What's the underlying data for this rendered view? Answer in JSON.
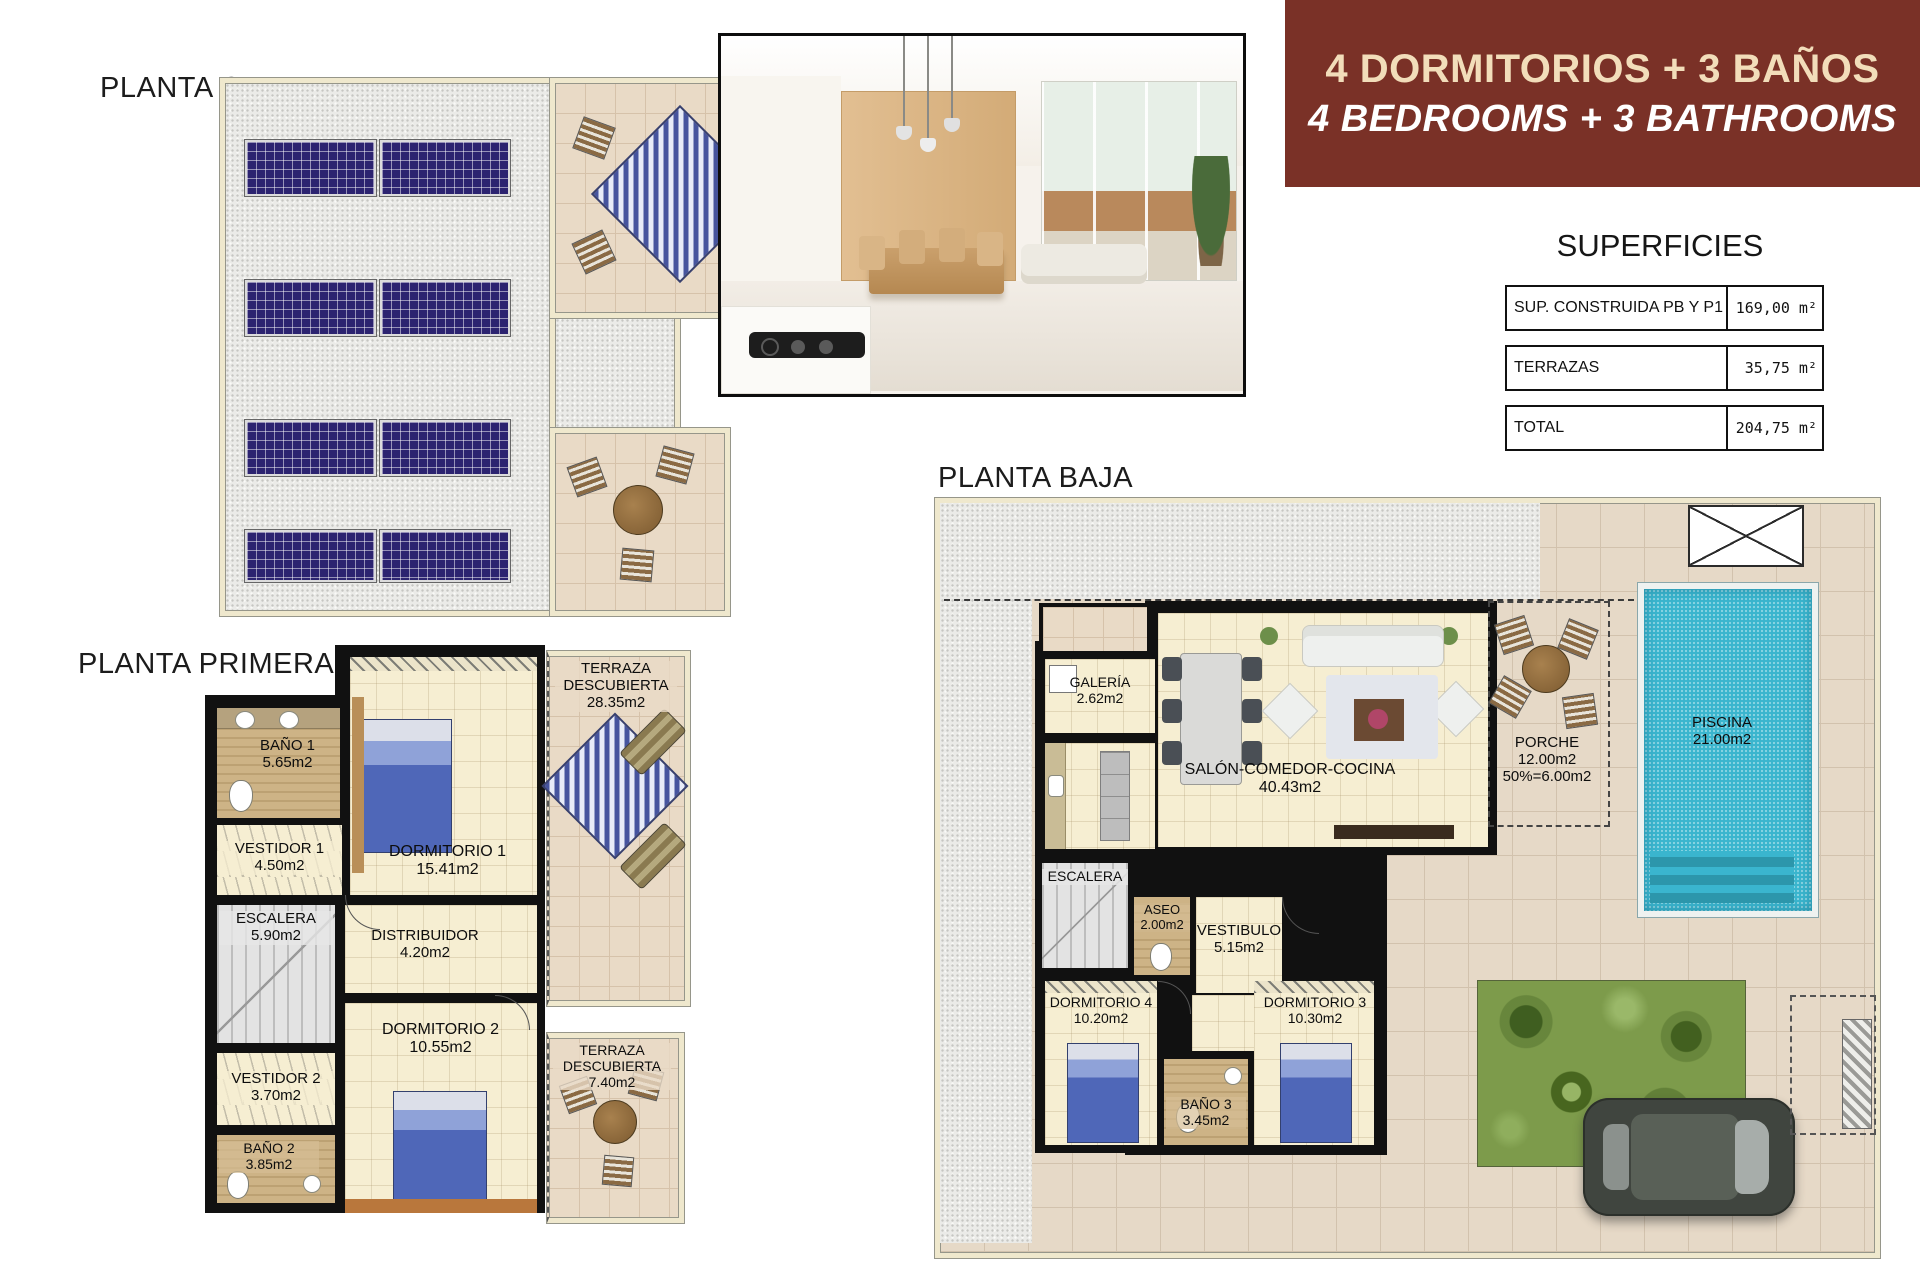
{
  "banner": {
    "line1": "4 DORMITORIOS + 3 BAÑOS",
    "line2": "4 BEDROOMS + 3 BATHROOMS",
    "bg_color": "#7a3127",
    "line1_color": "#f2ddba",
    "line2_color": "#ffffff"
  },
  "superficies": {
    "title": "SUPERFICIES",
    "rows": [
      {
        "label": "SUP. CONSTRUIDA PB Y P1",
        "value": "169,00 m²"
      },
      {
        "label": "TERRAZAS",
        "value": "35,75 m²"
      },
      {
        "label": "TOTAL",
        "value": "204,75 m²"
      }
    ]
  },
  "plans": {
    "cubierta": {
      "title": "PLANTA CUBIERTA"
    },
    "primera": {
      "title": "PLANTA PRIMERA",
      "rooms": {
        "bano1": {
          "name": "BAÑO 1",
          "area": "5.65m2"
        },
        "vestidor1": {
          "name": "VESTIDOR 1",
          "area": "4.50m2"
        },
        "dormitorio1": {
          "name": "DORMITORIO 1",
          "area": "15.41m2"
        },
        "terraza1": {
          "name": "TERRAZA DESCUBIERTA",
          "area": "28.35m2"
        },
        "escalera": {
          "name": "ESCALERA",
          "area": "5.90m2"
        },
        "distribuidor": {
          "name": "DISTRIBUIDOR",
          "area": "4.20m2"
        },
        "vestidor2": {
          "name": "VESTIDOR 2",
          "area": "3.70m2"
        },
        "dormitorio2": {
          "name": "DORMITORIO 2",
          "area": "10.55m2"
        },
        "bano2": {
          "name": "BAÑO 2",
          "area": "3.85m2"
        },
        "terraza2": {
          "name": "TERRAZA DESCUBIERTA",
          "area": "7.40m2"
        }
      }
    },
    "baja": {
      "title": "PLANTA BAJA",
      "rooms": {
        "galeria": {
          "name": "GALERÍA",
          "area": "2.62m2"
        },
        "salon": {
          "name": "SALÓN-COMEDOR-COCINA",
          "area": "40.43m2"
        },
        "porche": {
          "name": "PORCHE",
          "area": "12.00m2",
          "note": "50%=6.00m2"
        },
        "piscina": {
          "name": "PISCINA",
          "area": "21.00m2"
        },
        "escalera": {
          "name": "ESCALERA"
        },
        "aseo": {
          "name": "ASEO",
          "area": "2.00m2"
        },
        "vestibulo": {
          "name": "VESTIBULO",
          "area": "5.15m2"
        },
        "dormitorio4": {
          "name": "DORMITORIO 4",
          "area": "10.20m2"
        },
        "bano3": {
          "name": "BAÑO 3",
          "area": "3.45m2"
        },
        "dormitorio3": {
          "name": "DORMITORIO 3",
          "area": "10.30m2"
        }
      }
    }
  }
}
